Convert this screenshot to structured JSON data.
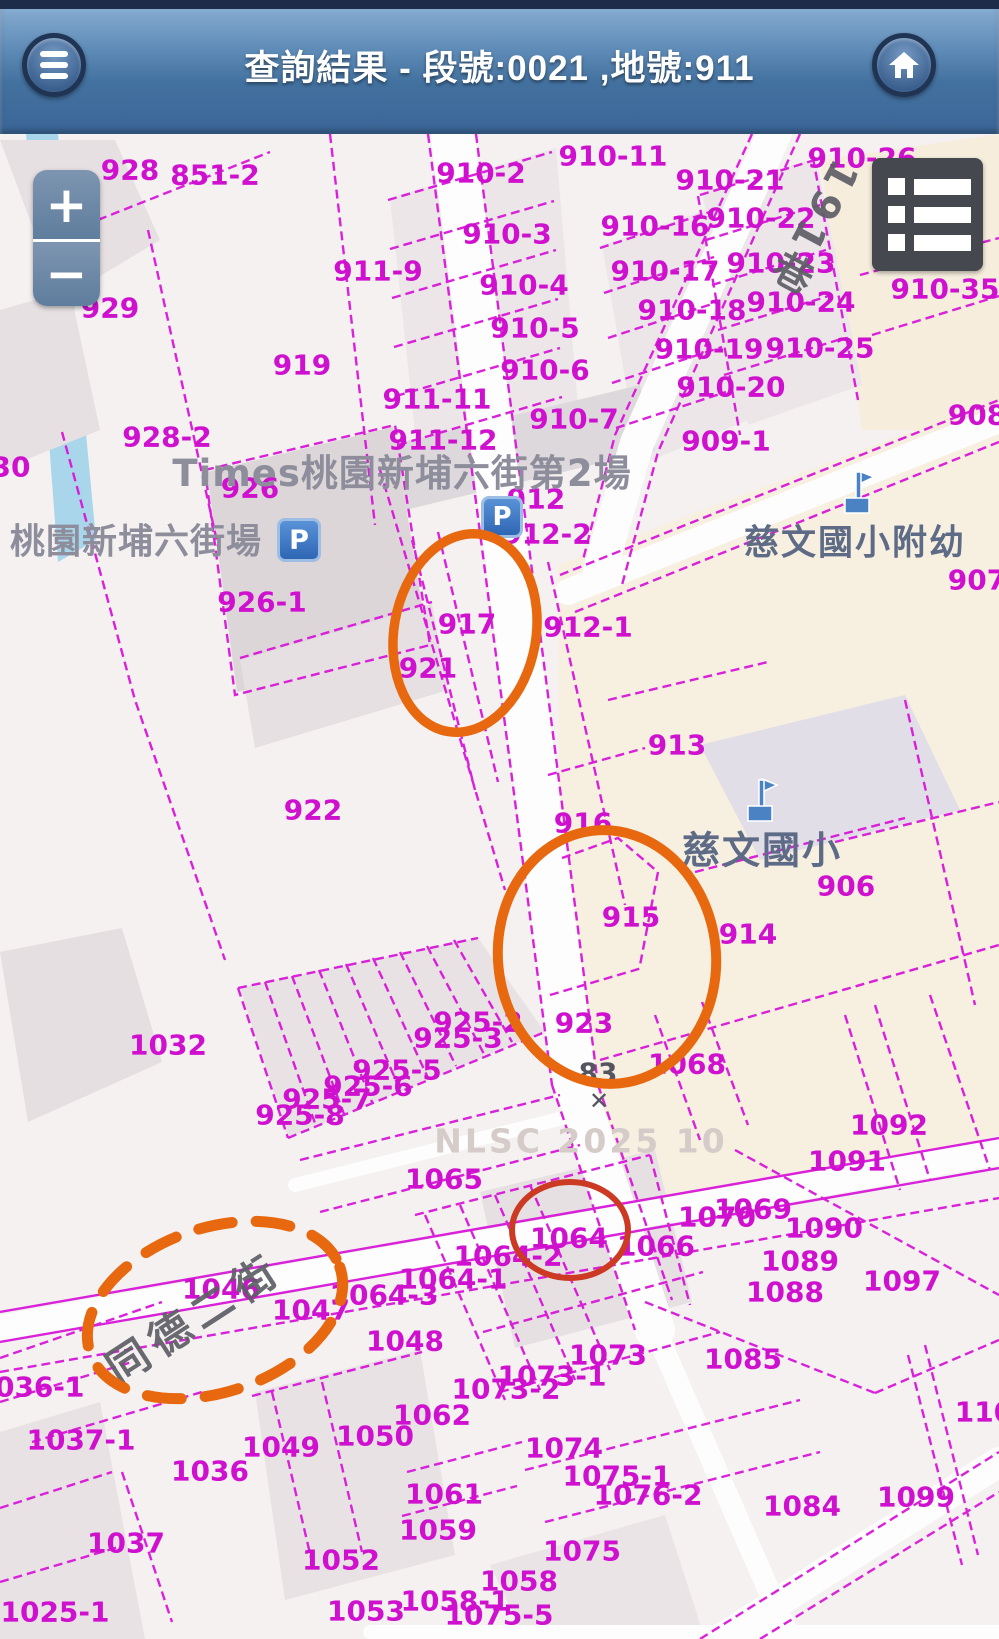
{
  "header": {
    "title": "查詢結果 - 段號:0021 ,地號:911"
  },
  "controls": {
    "zoom_in_label": "+",
    "zoom_out_label": "−"
  },
  "annotations": {
    "highlight_color": "#e8680f",
    "small_circle_color": "#cc3a24",
    "shapes": [
      "large-ellipse-917-921",
      "large-ellipse-915-923",
      "small-circle-1064",
      "dashed-ellipse-tongde-2nd-st"
    ]
  },
  "map": {
    "watermark": "NLSC 2025 10",
    "labels": [
      {
        "t": "928",
        "x": 130,
        "y": 170
      },
      {
        "t": "851-2",
        "x": 215,
        "y": 175
      },
      {
        "t": "910-2",
        "x": 481,
        "y": 173
      },
      {
        "t": "910-11",
        "x": 613,
        "y": 156
      },
      {
        "t": "910-26",
        "x": 862,
        "y": 158
      },
      {
        "t": "910-21",
        "x": 730,
        "y": 180
      },
      {
        "t": "910-16",
        "x": 655,
        "y": 226
      },
      {
        "t": "910-22",
        "x": 761,
        "y": 218
      },
      {
        "t": "910-3",
        "x": 507,
        "y": 234
      },
      {
        "t": "911-9",
        "x": 378,
        "y": 271
      },
      {
        "t": "910-17",
        "x": 665,
        "y": 271
      },
      {
        "t": "910-23",
        "x": 781,
        "y": 263
      },
      {
        "t": "910-4",
        "x": 524,
        "y": 285
      },
      {
        "t": "910-35",
        "x": 945,
        "y": 289
      },
      {
        "t": "910-18",
        "x": 692,
        "y": 310
      },
      {
        "t": "910-24",
        "x": 801,
        "y": 302
      },
      {
        "t": "929",
        "x": 110,
        "y": 308
      },
      {
        "t": "910-5",
        "x": 535,
        "y": 328
      },
      {
        "t": "910-19",
        "x": 709,
        "y": 349
      },
      {
        "t": "910-25",
        "x": 820,
        "y": 348
      },
      {
        "t": "919",
        "x": 302,
        "y": 365
      },
      {
        "t": "910-6",
        "x": 545,
        "y": 370
      },
      {
        "t": "910-20",
        "x": 731,
        "y": 387
      },
      {
        "t": "911-11",
        "x": 437,
        "y": 399
      },
      {
        "t": "908",
        "x": 977,
        "y": 415
      },
      {
        "t": "910-7",
        "x": 574,
        "y": 419
      },
      {
        "t": "928-2",
        "x": 167,
        "y": 437
      },
      {
        "t": "911-12",
        "x": 443,
        "y": 440
      },
      {
        "t": "909-1",
        "x": 726,
        "y": 441
      },
      {
        "t": "30",
        "x": 11,
        "y": 467
      },
      {
        "t": "926",
        "x": 250,
        "y": 488
      },
      {
        "t": "912",
        "x": 536,
        "y": 499
      },
      {
        "t": "912-2",
        "x": 547,
        "y": 534
      },
      {
        "t": "907",
        "x": 977,
        "y": 580
      },
      {
        "t": "926-1",
        "x": 262,
        "y": 602
      },
      {
        "t": "917",
        "x": 467,
        "y": 624
      },
      {
        "t": "912-1",
        "x": 588,
        "y": 627
      },
      {
        "t": "921",
        "x": 428,
        "y": 668
      },
      {
        "t": "913",
        "x": 677,
        "y": 745
      },
      {
        "t": "922",
        "x": 313,
        "y": 810
      },
      {
        "t": "916",
        "x": 583,
        "y": 823
      },
      {
        "t": "906",
        "x": 846,
        "y": 886
      },
      {
        "t": "915",
        "x": 631,
        "y": 917
      },
      {
        "t": "914",
        "x": 748,
        "y": 934
      },
      {
        "t": "925-2",
        "x": 478,
        "y": 1022
      },
      {
        "t": "923",
        "x": 584,
        "y": 1023
      },
      {
        "t": "925-3",
        "x": 458,
        "y": 1038
      },
      {
        "t": "1032",
        "x": 168,
        "y": 1045
      },
      {
        "t": "1068",
        "x": 687,
        "y": 1064
      },
      {
        "t": "925-5",
        "x": 397,
        "y": 1070
      },
      {
        "t": "925-6",
        "x": 368,
        "y": 1086
      },
      {
        "t": "925-7",
        "x": 327,
        "y": 1099
      },
      {
        "t": "925-8",
        "x": 300,
        "y": 1115
      },
      {
        "t": "1092",
        "x": 889,
        "y": 1125
      },
      {
        "t": "1091",
        "x": 847,
        "y": 1161
      },
      {
        "t": "1065",
        "x": 444,
        "y": 1179
      },
      {
        "t": "1069",
        "x": 753,
        "y": 1209
      },
      {
        "t": "1070",
        "x": 717,
        "y": 1217
      },
      {
        "t": "1090",
        "x": 824,
        "y": 1228
      },
      {
        "t": "1064",
        "x": 569,
        "y": 1238
      },
      {
        "t": "1066",
        "x": 656,
        "y": 1246
      },
      {
        "t": "1064-2",
        "x": 508,
        "y": 1256
      },
      {
        "t": "1089",
        "x": 800,
        "y": 1261
      },
      {
        "t": "1064-1",
        "x": 453,
        "y": 1279
      },
      {
        "t": "1097",
        "x": 902,
        "y": 1281
      },
      {
        "t": "1046",
        "x": 221,
        "y": 1289
      },
      {
        "t": "1088",
        "x": 785,
        "y": 1292
      },
      {
        "t": "1064-3",
        "x": 384,
        "y": 1295
      },
      {
        "t": "1047",
        "x": 311,
        "y": 1310
      },
      {
        "t": "1048",
        "x": 405,
        "y": 1341
      },
      {
        "t": "1073",
        "x": 608,
        "y": 1355
      },
      {
        "t": "1085",
        "x": 743,
        "y": 1359
      },
      {
        "t": "1073-1",
        "x": 552,
        "y": 1376
      },
      {
        "t": "1073-2",
        "x": 506,
        "y": 1389
      },
      {
        "t": "1036-1",
        "x": 30,
        "y": 1387
      },
      {
        "t": "110",
        "x": 984,
        "y": 1412
      },
      {
        "t": "1062",
        "x": 432,
        "y": 1415
      },
      {
        "t": "1050",
        "x": 375,
        "y": 1436
      },
      {
        "t": "1037-1",
        "x": 81,
        "y": 1440
      },
      {
        "t": "1049",
        "x": 281,
        "y": 1447
      },
      {
        "t": "1074",
        "x": 564,
        "y": 1448
      },
      {
        "t": "1036",
        "x": 210,
        "y": 1471
      },
      {
        "t": "1075-1",
        "x": 617,
        "y": 1476
      },
      {
        "t": "1061",
        "x": 444,
        "y": 1494
      },
      {
        "t": "1076-2",
        "x": 648,
        "y": 1495
      },
      {
        "t": "1099",
        "x": 916,
        "y": 1497
      },
      {
        "t": "1084",
        "x": 802,
        "y": 1506
      },
      {
        "t": "1059",
        "x": 438,
        "y": 1530
      },
      {
        "t": "1037",
        "x": 126,
        "y": 1543
      },
      {
        "t": "1075",
        "x": 582,
        "y": 1551
      },
      {
        "t": "1052",
        "x": 341,
        "y": 1560
      },
      {
        "t": "1058",
        "x": 519,
        "y": 1581
      },
      {
        "t": "1058-1",
        "x": 455,
        "y": 1601
      },
      {
        "t": "1053",
        "x": 366,
        "y": 1611
      },
      {
        "t": "1025-1",
        "x": 55,
        "y": 1612
      },
      {
        "t": "1075-5",
        "x": 499,
        "y": 1615
      },
      {
        "t": "Times桃園新埔六街第2場",
        "x": 402,
        "y": 470,
        "c": "poi",
        "s": 37
      },
      {
        "t": "桃園新埔六街場",
        "x": 136,
        "y": 539,
        "c": "poi",
        "s": 35
      },
      {
        "t": "慈文國小附幼",
        "x": 855,
        "y": 540,
        "c": "poi2",
        "s": 35
      },
      {
        "t": "慈文國小",
        "x": 762,
        "y": 847,
        "c": "poi2",
        "s": 38
      },
      {
        "t": "同德二街",
        "x": 193,
        "y": 1316,
        "c": "street",
        "s": 42,
        "r": -33
      },
      {
        "t": "191巷",
        "x": 812,
        "y": 228,
        "c": "street",
        "s": 40,
        "r": 28,
        "v": true
      },
      {
        "t": "NLSC 2025 10",
        "x": 581,
        "y": 1141,
        "c": "wm",
        "s": 33
      },
      {
        "t": "83",
        "x": 598,
        "y": 1073,
        "c": "marker",
        "s": 28
      },
      {
        "t": "✕",
        "x": 599,
        "y": 1101,
        "c": "marker",
        "s": 24
      }
    ]
  }
}
